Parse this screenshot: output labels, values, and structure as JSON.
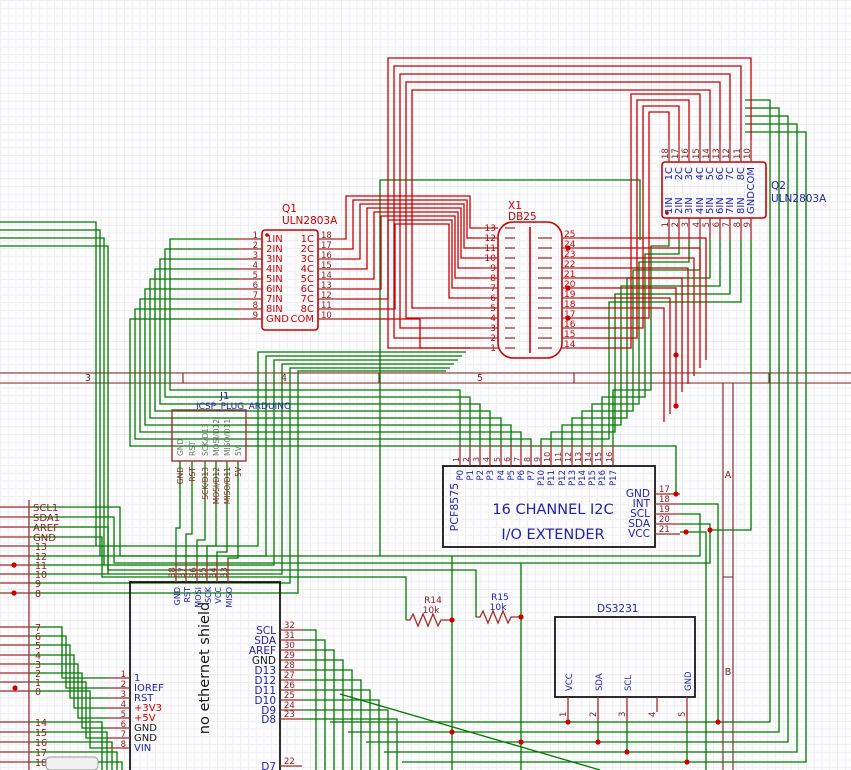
{
  "colors": {
    "wire_green": "#007a00",
    "wire_red": "#cc0000",
    "pin_dark": "#8b2020",
    "text_navy": "#2222aa",
    "box_black": "#161616",
    "grid": "#ededf2"
  },
  "frame": {
    "cols": [
      "3",
      "4",
      "5"
    ],
    "rows": [
      "A",
      "B"
    ]
  },
  "q1": {
    "ref": "Q1",
    "val": "ULN2803A",
    "l": [
      {
        "n": "1",
        "t": "1IN"
      },
      {
        "n": "2",
        "t": "2IN"
      },
      {
        "n": "3",
        "t": "3IN"
      },
      {
        "n": "4",
        "t": "4IN"
      },
      {
        "n": "5",
        "t": "5IN"
      },
      {
        "n": "6",
        "t": "6IN"
      },
      {
        "n": "7",
        "t": "7IN"
      },
      {
        "n": "8",
        "t": "8IN"
      },
      {
        "n": "9",
        "t": "GND"
      }
    ],
    "r": [
      {
        "n": "18",
        "t": "1C"
      },
      {
        "n": "17",
        "t": "2C"
      },
      {
        "n": "16",
        "t": "3C"
      },
      {
        "n": "15",
        "t": "4C"
      },
      {
        "n": "14",
        "t": "5C"
      },
      {
        "n": "13",
        "t": "6C"
      },
      {
        "n": "12",
        "t": "7C"
      },
      {
        "n": "11",
        "t": "8C"
      },
      {
        "n": "10",
        "t": "COM"
      }
    ]
  },
  "x1": {
    "ref": "X1",
    "val": "DB25",
    "l": [
      "13",
      "12",
      "11",
      "10",
      "9",
      "8",
      "7",
      "6",
      "5",
      "4",
      "3",
      "2",
      "1"
    ],
    "r": [
      "25",
      "24",
      "23",
      "22",
      "21",
      "20",
      "19",
      "18",
      "17",
      "16",
      "15",
      "14"
    ]
  },
  "q2": {
    "ref": "Q2",
    "val": "ULN2803A",
    "t": [
      {
        "n": "18",
        "t": "1C"
      },
      {
        "n": "17",
        "t": "2C"
      },
      {
        "n": "16",
        "t": "3C"
      },
      {
        "n": "15",
        "t": "4C"
      },
      {
        "n": "14",
        "t": "5C"
      },
      {
        "n": "13",
        "t": "6C"
      },
      {
        "n": "12",
        "t": "7C"
      },
      {
        "n": "11",
        "t": "8C"
      },
      {
        "n": "10",
        "t": "COM"
      }
    ],
    "b": [
      {
        "n": "1",
        "t": "1IN"
      },
      {
        "n": "2",
        "t": "2IN"
      },
      {
        "n": "3",
        "t": "3IN"
      },
      {
        "n": "4",
        "t": "4IN"
      },
      {
        "n": "5",
        "t": "5IN"
      },
      {
        "n": "6",
        "t": "6IN"
      },
      {
        "n": "7",
        "t": "7IN"
      },
      {
        "n": "8",
        "t": "8IN"
      },
      {
        "n": "9",
        "t": "GND"
      }
    ]
  },
  "j1": {
    "ref": "J1",
    "val": "ICSP_PLUG_ARDUINO",
    "pins": [
      "GND",
      "RST",
      "SCK/D13",
      "MOSI/D12",
      "MISO/D11",
      "5V"
    ],
    "nets": [
      "GND",
      "RST",
      "SCK/D13",
      "MOSI/D12",
      "MISO/D11",
      "5V"
    ]
  },
  "pcf": {
    "name": "PCF8575",
    "l1": "16 CHANNEL I2C",
    "l2": "I/O EXTENDER",
    "top": [
      {
        "n": "1",
        "t": "P0"
      },
      {
        "n": "2",
        "t": "P1"
      },
      {
        "n": "3",
        "t": "P2"
      },
      {
        "n": "4",
        "t": "P3"
      },
      {
        "n": "5",
        "t": "P4"
      },
      {
        "n": "6",
        "t": "P5"
      },
      {
        "n": "7",
        "t": "P6"
      },
      {
        "n": "8",
        "t": "P7"
      },
      {
        "n": "9",
        "t": "P10"
      },
      {
        "n": "10",
        "t": "P11"
      },
      {
        "n": "11",
        "t": "P12"
      },
      {
        "n": "12",
        "t": "P13"
      },
      {
        "n": "13",
        "t": "P14"
      },
      {
        "n": "14",
        "t": "P15"
      },
      {
        "n": "15",
        "t": "P16"
      },
      {
        "n": "16",
        "t": "P17"
      }
    ],
    "right": [
      {
        "t": "GND",
        "n": "17"
      },
      {
        "t": "INT",
        "n": "18"
      },
      {
        "t": "SCL",
        "n": "19"
      },
      {
        "t": "SDA",
        "n": "20"
      },
      {
        "t": "VCC",
        "n": "21"
      }
    ]
  },
  "sh": {
    "name": "no ethernet shield",
    "top": [
      {
        "n": "38",
        "t": "GND"
      },
      {
        "n": "37",
        "t": "RST"
      },
      {
        "n": "36",
        "t": "MOSI"
      },
      {
        "n": "35",
        "t": "SCK"
      },
      {
        "n": "34",
        "t": "VCC"
      },
      {
        "n": "33",
        "t": "MISO"
      }
    ],
    "left": [
      {
        "n": "1",
        "t": "1"
      },
      {
        "n": "2",
        "t": "IOREF"
      },
      {
        "n": "3",
        "t": "RST"
      },
      {
        "n": "4",
        "t": "+3V3"
      },
      {
        "n": "5",
        "t": "+5V"
      },
      {
        "n": "6",
        "t": "GND"
      },
      {
        "n": "7",
        "t": "GND"
      },
      {
        "n": "8",
        "t": "VIN"
      }
    ],
    "right": [
      {
        "t": "SCL",
        "n": "32"
      },
      {
        "t": "SDA",
        "n": "31"
      },
      {
        "t": "AREF",
        "n": "30"
      },
      {
        "t": "GND",
        "n": "29"
      },
      {
        "t": "D13",
        "n": "28"
      },
      {
        "t": "D12",
        "n": "27"
      },
      {
        "t": "D11",
        "n": "26"
      },
      {
        "t": "D10",
        "n": "25"
      },
      {
        "t": "D9",
        "n": "24"
      },
      {
        "t": "D8",
        "n": "23"
      }
    ],
    "bot": {
      "t": "D7",
      "n": "22"
    }
  },
  "ds": {
    "val": "DS3231",
    "pins": [
      {
        "n": "1",
        "t": "VCC"
      },
      {
        "n": "2",
        "t": "SDA"
      },
      {
        "n": "3",
        "t": "SCL"
      },
      {
        "n": "4",
        "t": ""
      },
      {
        "n": "5",
        "t": "GND"
      }
    ]
  },
  "r14": {
    "ref": "R14",
    "val": "10k"
  },
  "r15": {
    "ref": "R15",
    "val": "10k"
  },
  "lc": {
    "labels": [
      "SCL1",
      "SDA1",
      "AREF",
      "GND"
    ],
    "nums": [
      "13",
      "12",
      "11",
      "10",
      "9",
      "8",
      "7",
      "6",
      "5",
      "4",
      "3",
      "2",
      "1",
      "0",
      "14",
      "15",
      "16",
      "17",
      "18"
    ]
  }
}
